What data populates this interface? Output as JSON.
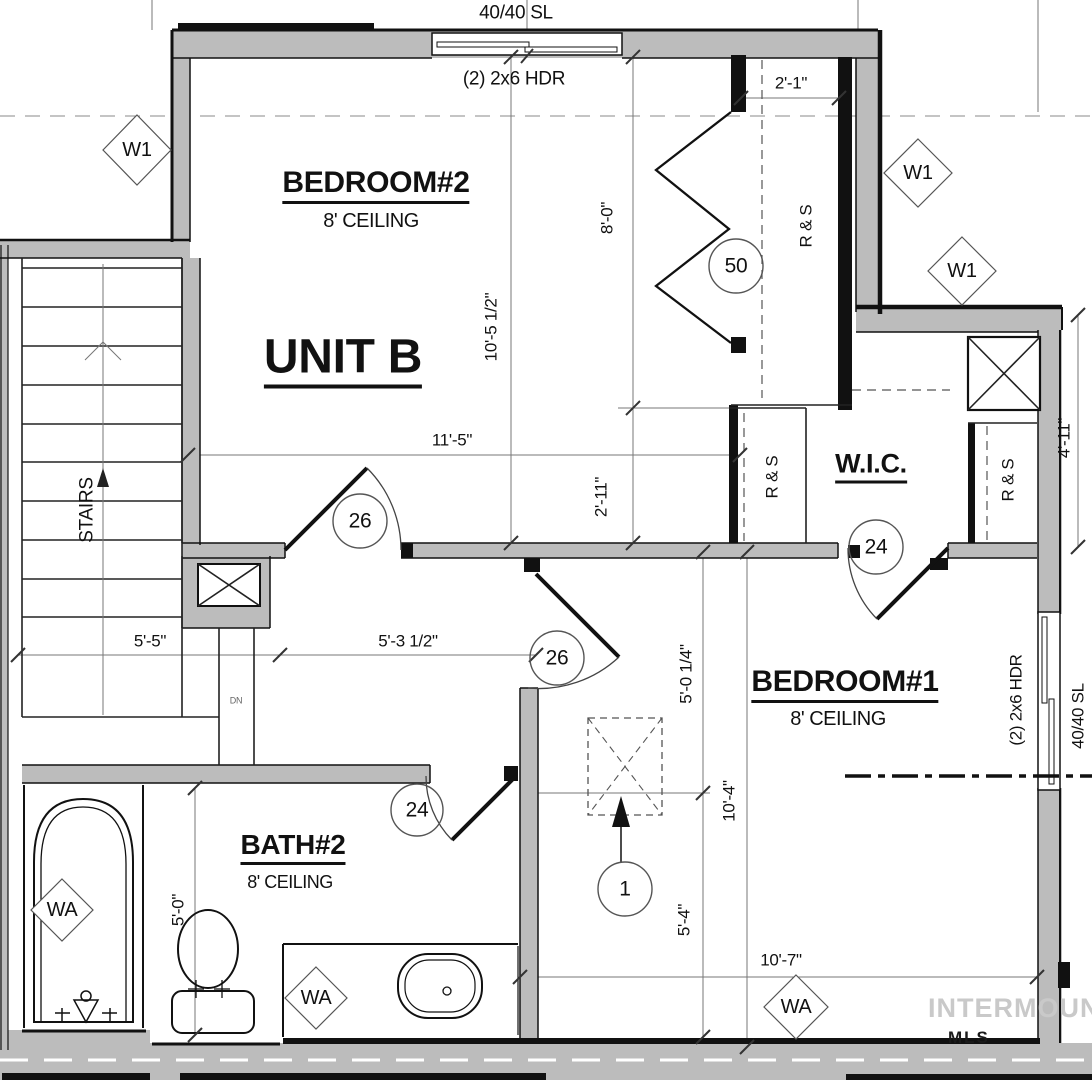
{
  "unit": {
    "label": "UNIT B"
  },
  "rooms": {
    "bedroom2": {
      "name": "BEDROOM#2",
      "ceiling": "8' CEILING"
    },
    "bedroom1": {
      "name": "BEDROOM#1",
      "ceiling": "8' CEILING"
    },
    "bath2": {
      "name": "BATH#2",
      "ceiling": "8' CEILING"
    },
    "wic": {
      "name": "W.I.C."
    },
    "stairs": {
      "label": "STAIRS",
      "dn": "DN"
    }
  },
  "windows": {
    "top": {
      "size": "40/40 SL",
      "header": "(2) 2x6 HDR"
    },
    "right": {
      "size": "40/40 SL",
      "header": "(2) 2x6 HDR"
    }
  },
  "closets": {
    "upper_rs": "R & S",
    "wic_left_rs": "R & S",
    "wic_right_rs": "R & S"
  },
  "tags": {
    "w1": "W1",
    "wa": "WA",
    "door_bifold": "50",
    "door_bedroom2": "26",
    "door_hall": "26",
    "door_wic": "24",
    "door_bath": "24",
    "attic_access": "1"
  },
  "dims": {
    "d10_5_half": "10'-5 1/2\"",
    "d8_0": "8'-0\"",
    "d2_1": "2'-1\"",
    "d2_11": "2'-11\"",
    "d11_5": "11'-5\"",
    "d4_11": "4'-11\"",
    "d5_5": "5'-5\"",
    "d5_3_half": "5'-3 1/2\"",
    "d5_0_quarter": "5'-0 1/4\"",
    "d10_4": "10'-4\"",
    "d5_4": "5'-4\"",
    "d10_7": "10'-7\"",
    "d5_0": "5'-0\""
  },
  "watermark": {
    "text": "INTERMOUNTAIN",
    "text2": "MLS"
  },
  "colors": {
    "wall_fill": "#bcbcbc",
    "line": "#111111",
    "dim_line": "#777777",
    "watermark": "#c9c9c9"
  }
}
